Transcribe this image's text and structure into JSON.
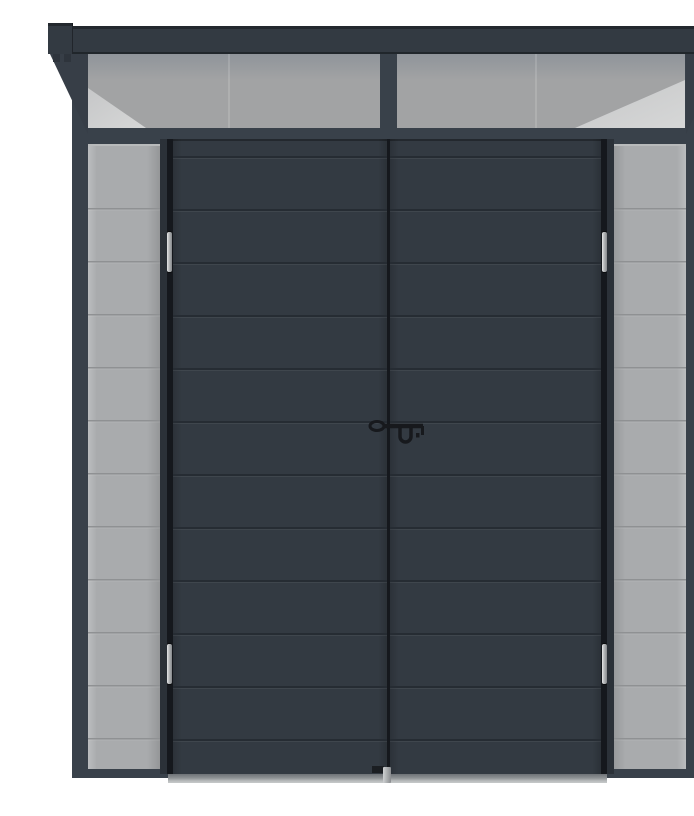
{
  "scene": {
    "type": "product-photo",
    "subject": "Anthracite grey metal pent-roof garden shed, front view, with closed double doors",
    "description": "Front elevation of an anthracite grey metal garden shed: flat pent roof with overhanging dark fascia and angled side brackets, a two-pane translucent grey skylight strip under the roof, light grey horizontally-ribbed side wall panels, closed horizontally-ribbed anthracite double doors with four chrome hinges, a black drop-T handle with padlock eyelet, and an aluminium threshold strip"
  },
  "structure": {
    "roof": "flat pent roof, dark overhanging fascia, triangular side brackets",
    "skylight": {
      "panes": 2,
      "finish": "translucent grey polycarbonate"
    },
    "doors": {
      "count": 2,
      "ribs_per_door": 12,
      "finish": "anthracite horizontal-rib metal"
    },
    "side_panels": {
      "count": 2,
      "ribs_per_panel": 11,
      "finish": "light grey horizontal-rib metal"
    },
    "hinges": {
      "count": 4,
      "finish": "chrome"
    },
    "handle": "black drop-T lever with padlock eyelet",
    "threshold": "aluminium threshold strip with centre drop-bolt plate"
  },
  "palette": {
    "background": "#ffffff",
    "fascia": "#333a42",
    "fascia_edge": "#23282e",
    "frame": "#39414a",
    "jamb": "#2b3138",
    "door": "#333a42",
    "groove": "#262c33",
    "gap": "#15181d",
    "panel": "#a9abad",
    "panel_seam": "#8f9193",
    "pane": "#a2a3a4",
    "pane_shadow": "#8f949a",
    "pane_light": "#d6d7d7",
    "threshold_dark": "#6e7276",
    "threshold_light": "#c7c9ca",
    "hinge_light": "#e6e7e8",
    "hinge_dark": "#85888b",
    "handle": "#17191d"
  }
}
